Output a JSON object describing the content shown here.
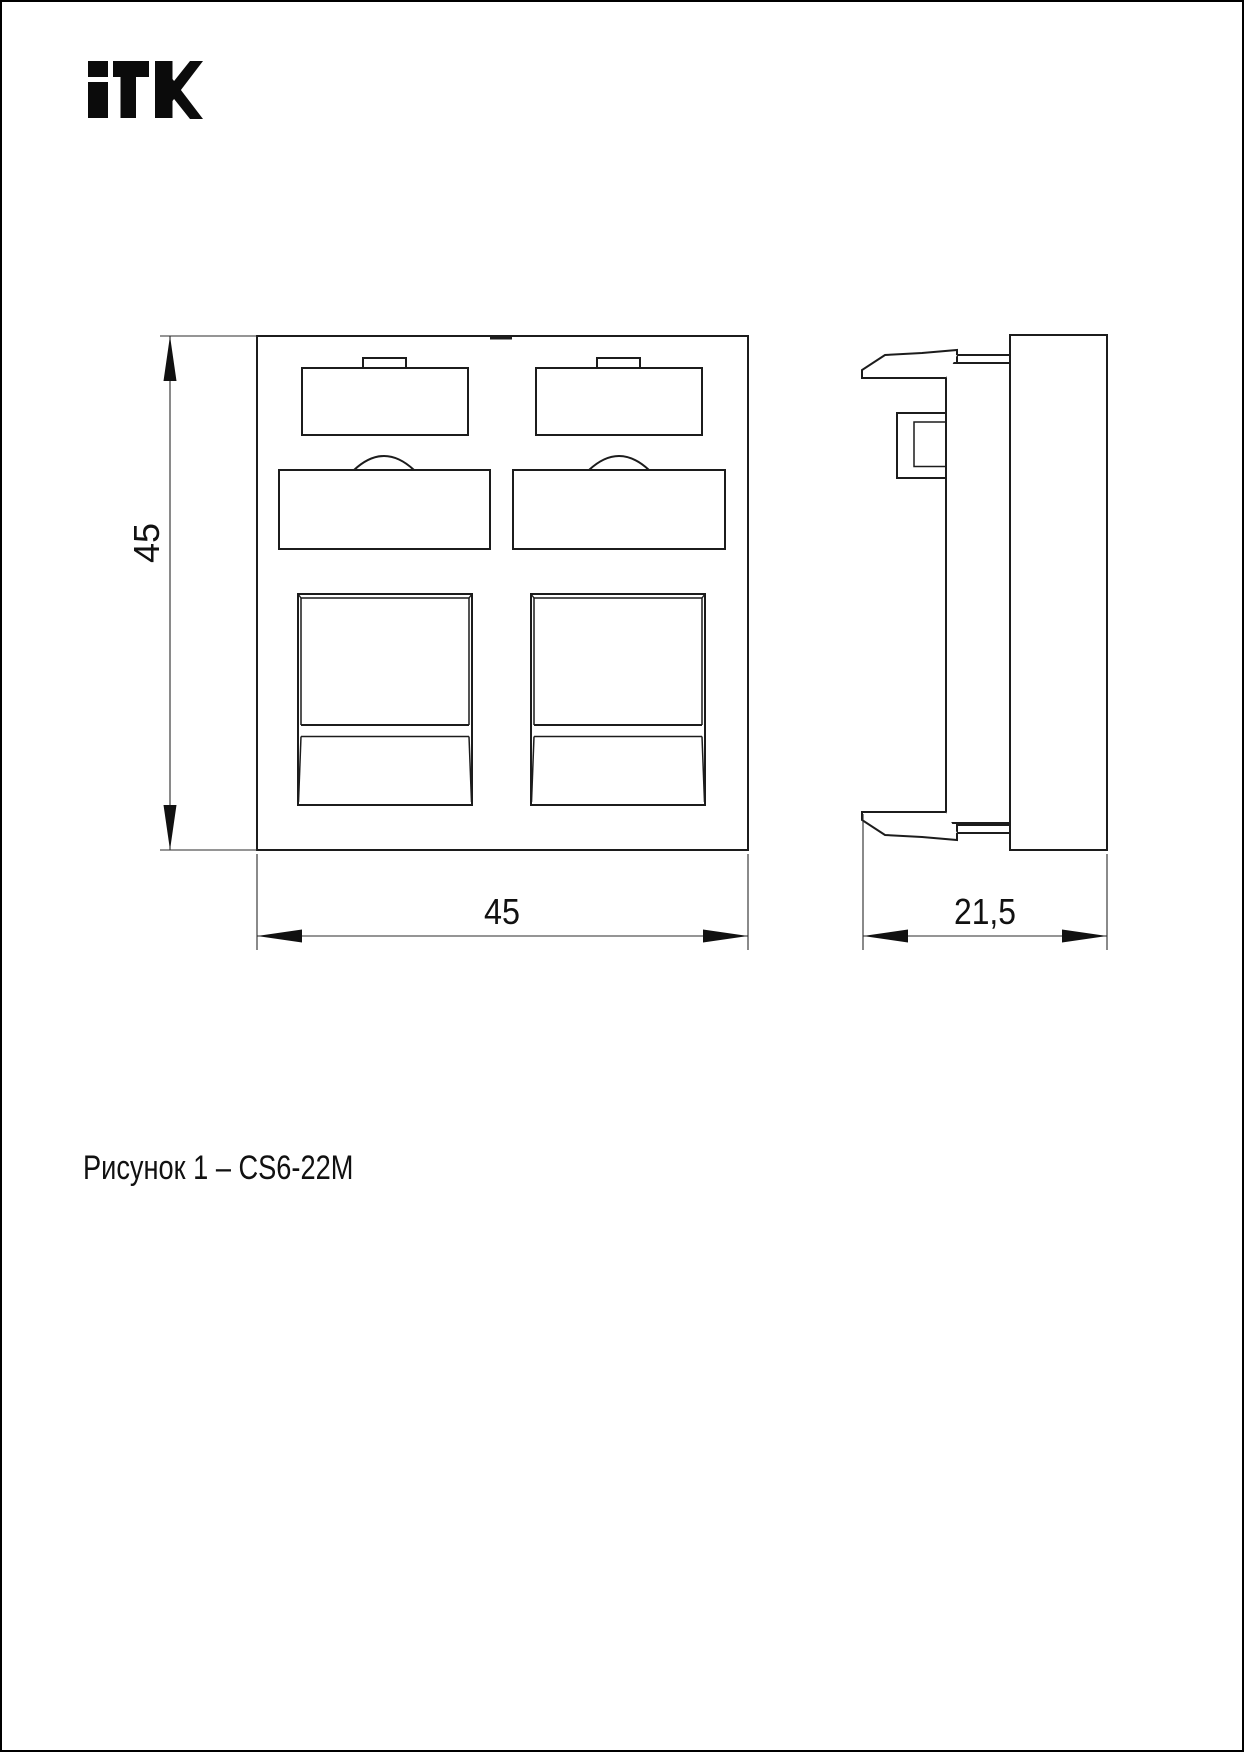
{
  "page": {
    "background": "#ffffff",
    "border_color": "#000000",
    "line_color": "#1c1c1c"
  },
  "logo": {
    "text": "ITK",
    "color": "#0b0b0b"
  },
  "drawing": {
    "caption": "Рисунок 1 – CS6-22M",
    "dimensions": {
      "front_height": "45",
      "front_width": "45",
      "side_depth": "21,5"
    }
  }
}
